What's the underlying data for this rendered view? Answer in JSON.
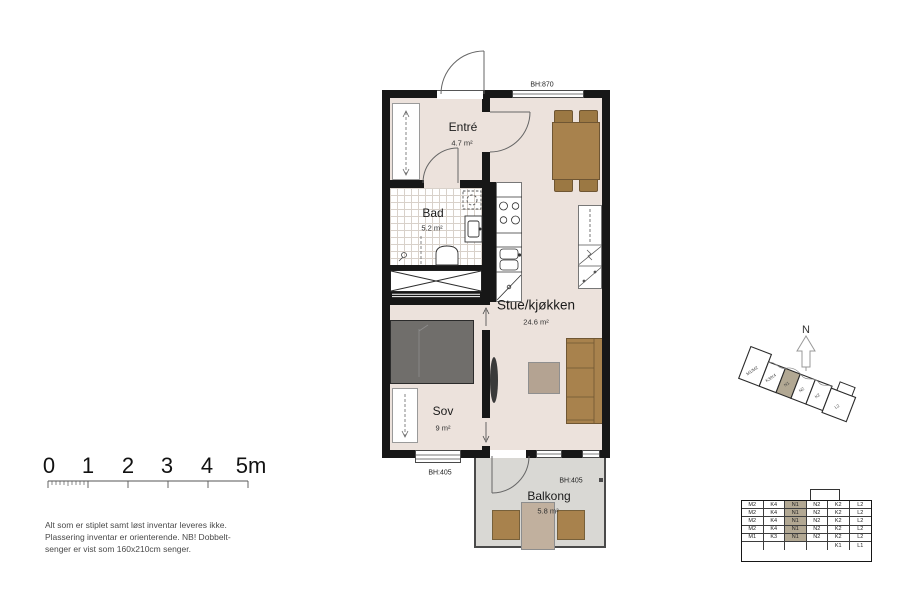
{
  "plan": {
    "rooms": {
      "entre": {
        "name": "Entré",
        "area": "4.7 m²"
      },
      "bad": {
        "name": "Bad",
        "area": "5.2 m²"
      },
      "sov": {
        "name": "Sov",
        "area": "9 m²"
      },
      "stue": {
        "name": "Stue/kjøkken",
        "area": "24.6 m²"
      },
      "balkong": {
        "name": "Balkong",
        "area": "5.8 m²"
      }
    },
    "window_labels": {
      "top": "BH:870",
      "sov": "BH:405",
      "balkong": "BH:405"
    }
  },
  "scalebar": {
    "labels": [
      "0",
      "1",
      "2",
      "3",
      "4",
      "5m"
    ]
  },
  "disclaimer": {
    "line1": "Alt som er stiplet samt løst inventar leveres ikke.",
    "line2": "Plassering inventar er orienterende. NB! Dobbelt-",
    "line3": "senger er vist som 160x210cm senger."
  },
  "compass": {
    "label": "N"
  },
  "locator": {
    "units": [
      {
        "label": "M1/M2",
        "highlighted": false
      },
      {
        "label": "K3/K4",
        "highlighted": false
      },
      {
        "label": "N1",
        "highlighted": true
      },
      {
        "label": "N2",
        "highlighted": false
      },
      {
        "label": "K2",
        "highlighted": false
      },
      {
        "label": "L2",
        "highlighted": false
      }
    ]
  },
  "stack_table": {
    "rows": [
      [
        "M2",
        "K4",
        "N1",
        "N2",
        "K2",
        "L2"
      ],
      [
        "M2",
        "K4",
        "N1",
        "N2",
        "K2",
        "L2"
      ],
      [
        "M2",
        "K4",
        "N1",
        "N2",
        "K2",
        "L2"
      ],
      [
        "M2",
        "K4",
        "N1",
        "N2",
        "K2",
        "L2"
      ],
      [
        "M1",
        "K3",
        "N1",
        "N2",
        "K2",
        "L2"
      ],
      [
        "",
        "",
        "",
        "",
        "K1",
        "L1"
      ]
    ],
    "highlighted_value": "N1"
  },
  "colors": {
    "floor": "#ece2dc",
    "balcony_floor": "#d9d8d4",
    "wall": "#171717",
    "wood": "#a8824d",
    "bed": "#706e6b",
    "coffee_table": "#b4a392",
    "highlight": "#b2a893"
  }
}
